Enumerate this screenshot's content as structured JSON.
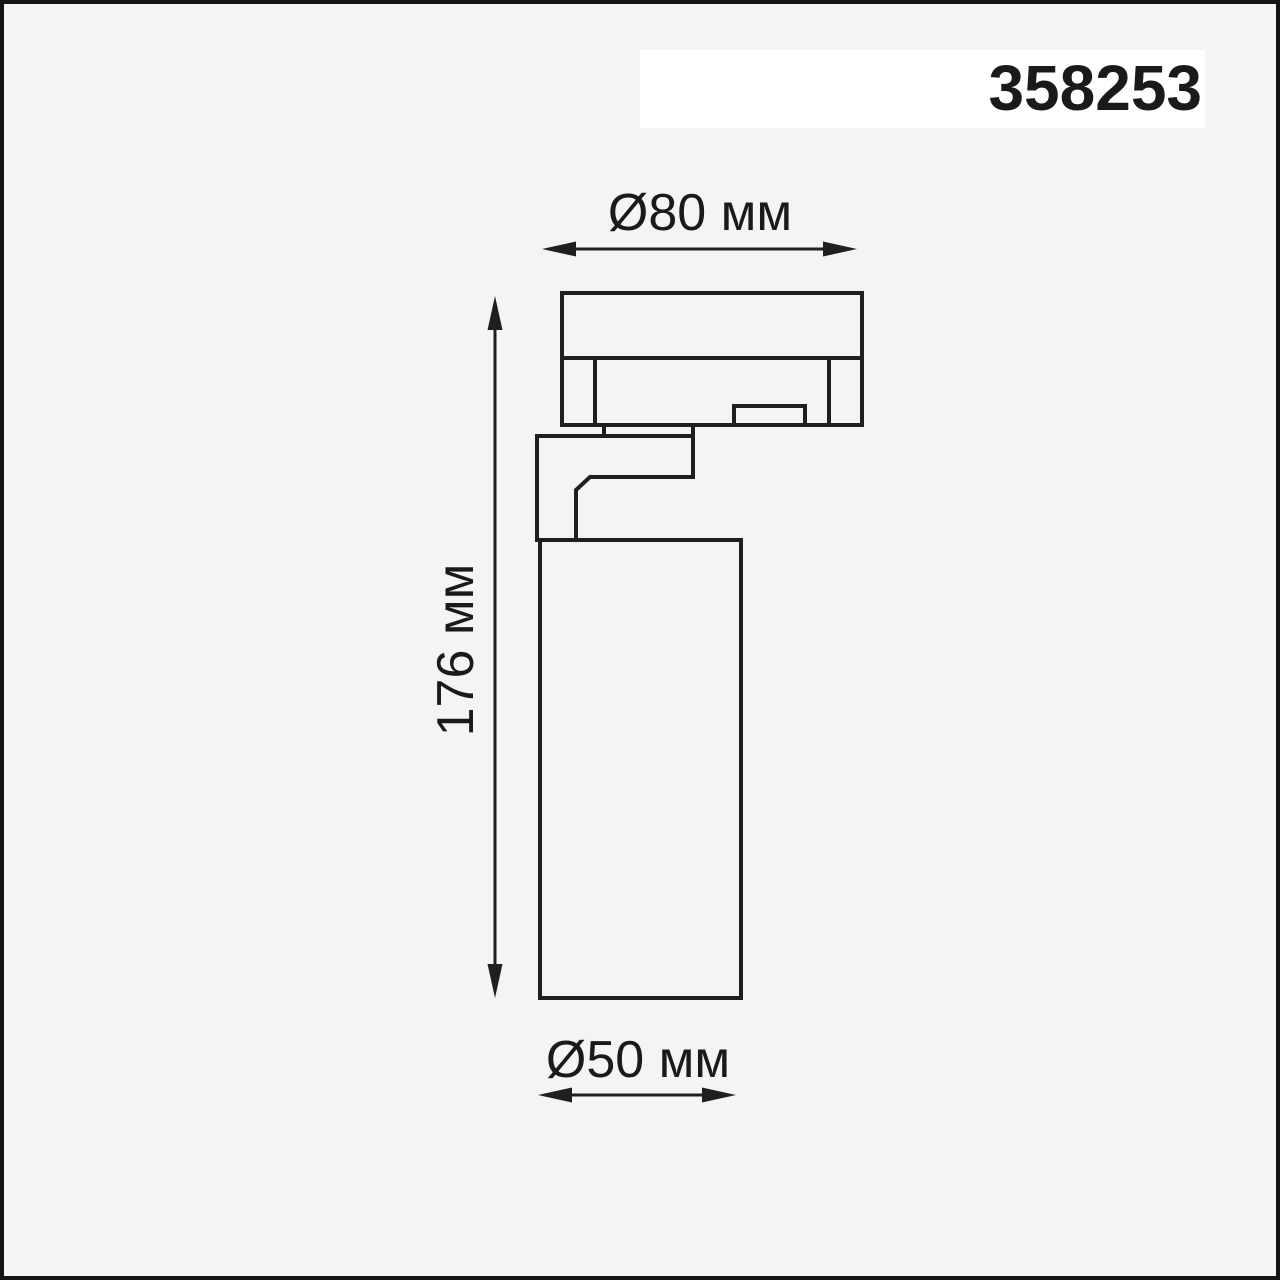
{
  "page": {
    "background_color": "#f4f4f5",
    "frame_color": "#141414",
    "band_color": "#ffffff",
    "line_color": "#1f1f1f",
    "text_color": "#1a1a1a"
  },
  "product": {
    "article_number": "358253"
  },
  "drawing": {
    "dimensions": {
      "top_width": "Ø80 мм",
      "left_height": "176 мм",
      "bottom_diameter": "Ø50 мм"
    }
  }
}
